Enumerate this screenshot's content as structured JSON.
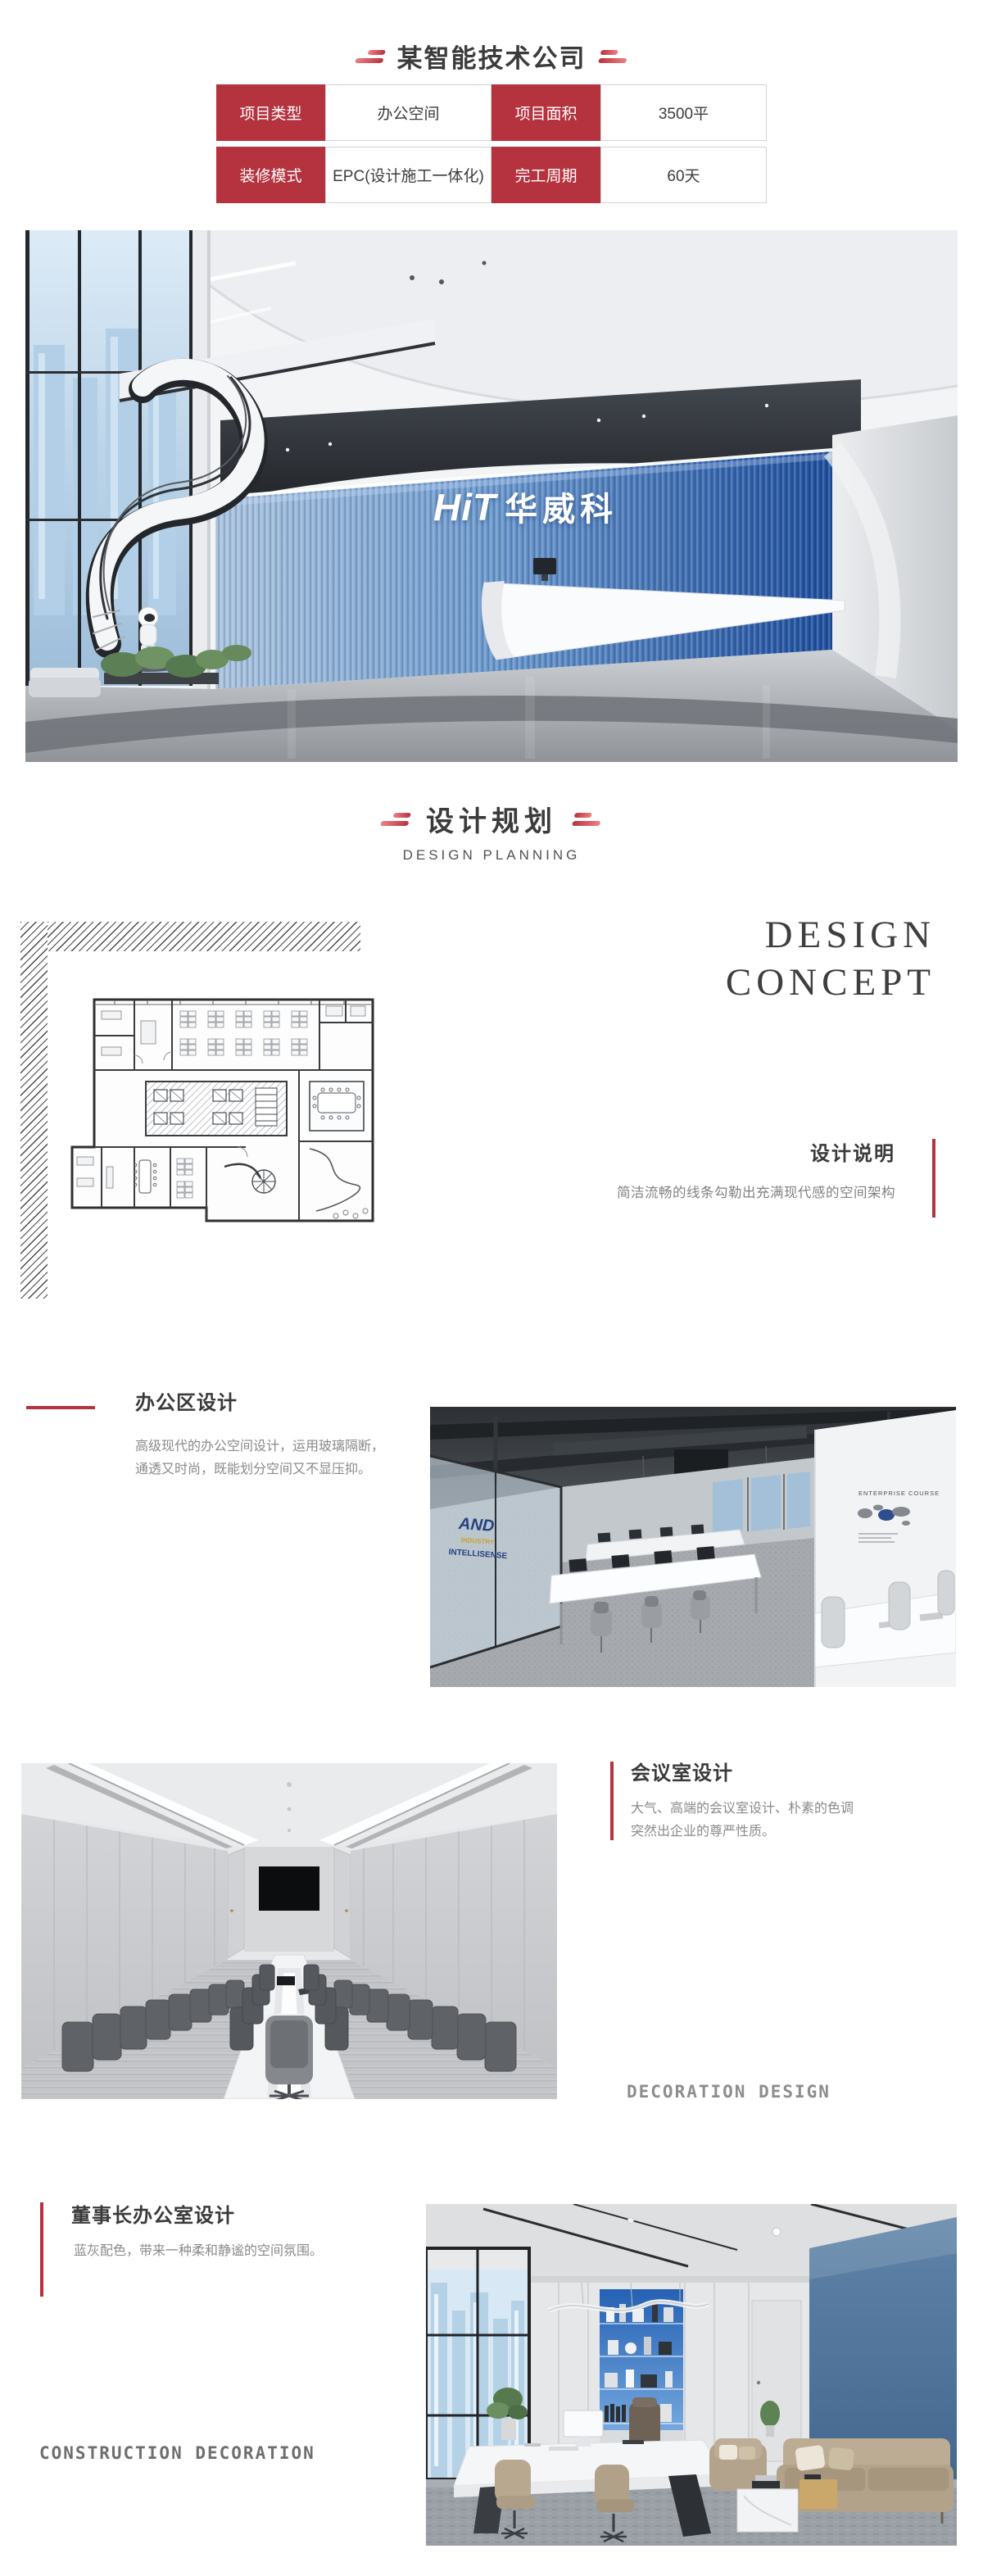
{
  "colors": {
    "accent_red": "#b5333f",
    "title_text": "#3b3b3b",
    "body_text": "#8a8a8a",
    "hero_wall_blue": "#1c4c9b",
    "chairman_wall_blue": "#4a6e96"
  },
  "header": {
    "title": "某智能技术公司"
  },
  "info_table": {
    "r1": {
      "label1": "项目类型",
      "value1": "办公空间",
      "label2": "项目面积",
      "value2": "3500平"
    },
    "r2": {
      "label1": "装修模式",
      "value1": "EPC(设计施工一体化)",
      "label2": "完工周期",
      "value2": "60天"
    }
  },
  "hero": {
    "wall_logo_en": "HiT",
    "wall_logo_cn": "华威科"
  },
  "planning": {
    "title_cn": "设计规划",
    "title_en": "DESIGN PLANNING"
  },
  "concept": {
    "heading_line1": "DESIGN",
    "heading_line2": "CONCEPT",
    "subtitle": "设计说明",
    "description": "简洁流畅的线条勾勒出充满现代感的空间架构"
  },
  "office_section": {
    "title": "办公区设计",
    "description": "高级现代的办公空间设计，运用玻璃隔断，\n通透又时尚，既能划分空间又不显压抑。"
  },
  "office_photo": {
    "glass_decal_1": "AND",
    "glass_decal_2": "INDUSTRY",
    "glass_decal_3": "INTELLISENSE",
    "wall_heading": "ENTERPRISE COURSE"
  },
  "meeting_section": {
    "title": "会议室设计",
    "description": "大气、高端的会议室设计、朴素的色调\n突然出企业的尊严性质。",
    "watermark": "DECORATION DESIGN"
  },
  "chairman_section": {
    "title": "董事长办公室设计",
    "description": "蓝灰配色，带来一种柔和静谧的空间氛围。",
    "watermark": "CONSTRUCTION DECORATION"
  }
}
